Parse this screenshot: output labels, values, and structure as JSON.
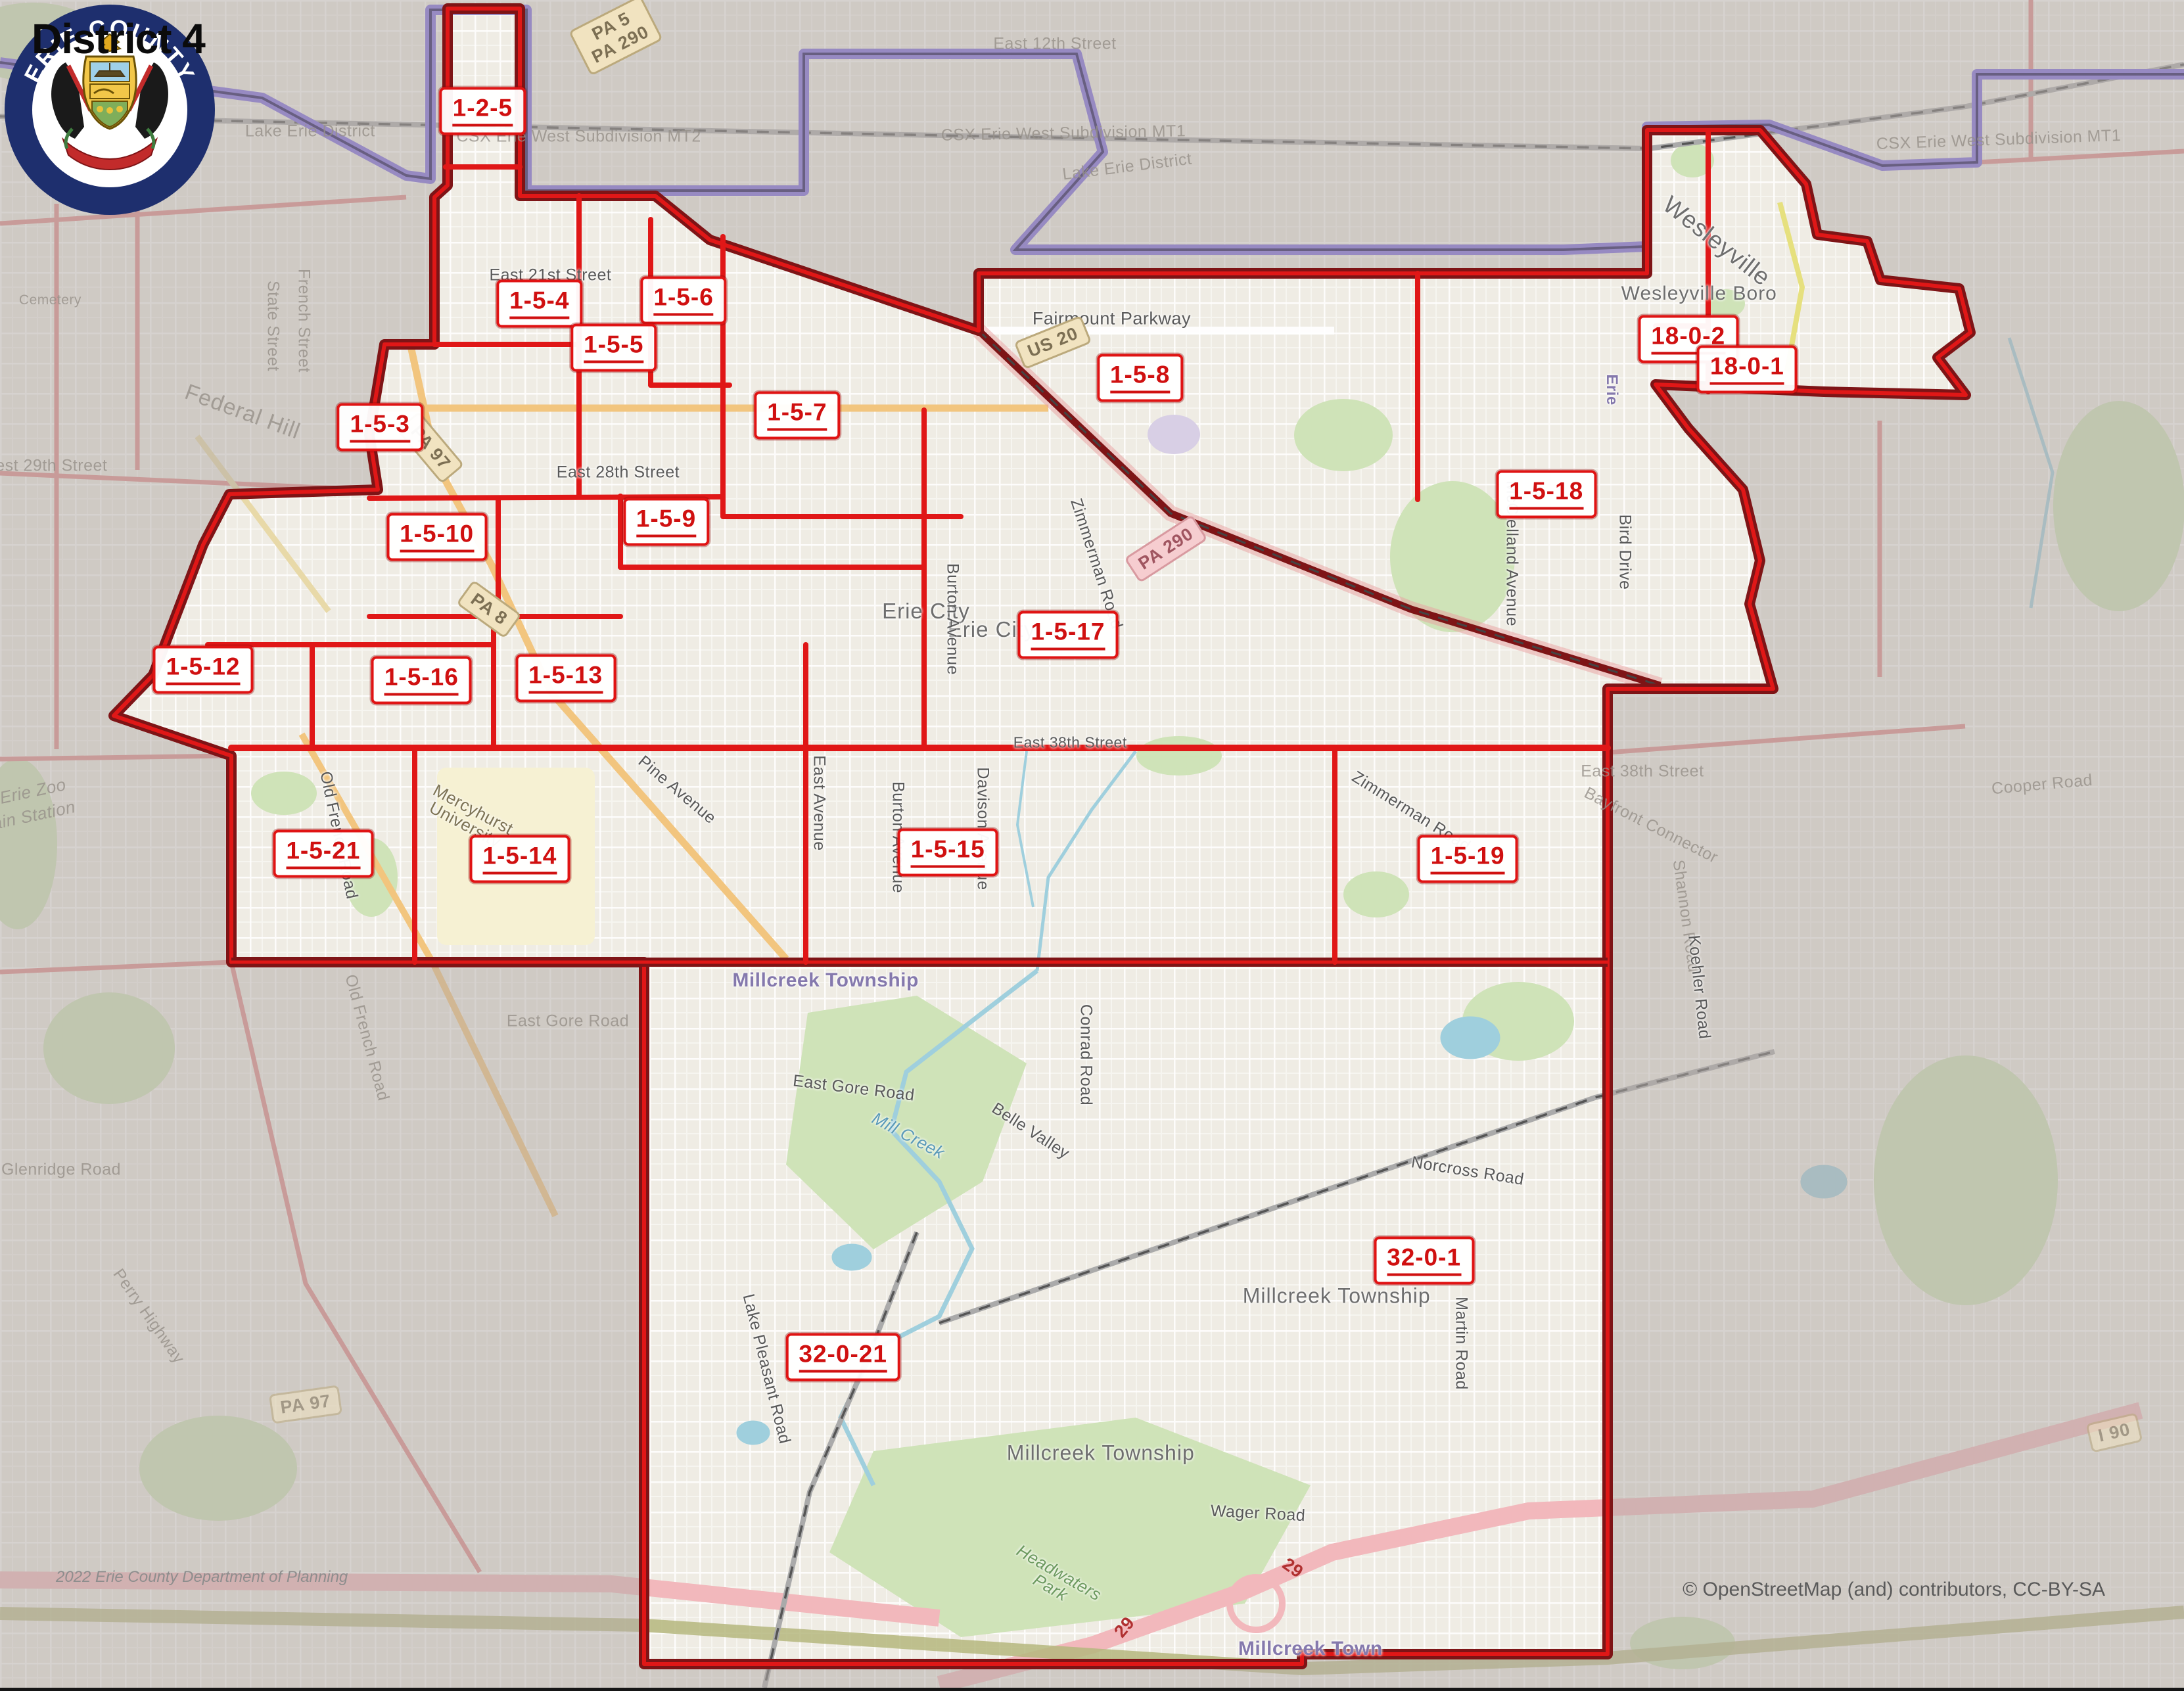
{
  "title": "District 4",
  "attribution": "© OpenStreetMap (and) contributors, CC-BY-SA",
  "credit": "2022 Erie County Department of Planning",
  "seal": {
    "top": "ERIE COUNTY",
    "bottom": "PENNSYLVANIA"
  },
  "colors": {
    "precinct_red": "#d01010",
    "boundary_dark": "#7e1416",
    "boundary_bright": "#e01717",
    "city_line_purple": "#978ac2",
    "outside_veil": "#b3aba6"
  },
  "precincts": [
    {
      "label": "1-2-5",
      "x": 22.1,
      "y": 6.6
    },
    {
      "label": "1-5-4",
      "x": 24.7,
      "y": 18.0
    },
    {
      "label": "1-5-6",
      "x": 31.3,
      "y": 17.8
    },
    {
      "label": "1-5-5",
      "x": 28.1,
      "y": 20.6
    },
    {
      "label": "1-5-3",
      "x": 17.4,
      "y": 25.3
    },
    {
      "label": "1-5-7",
      "x": 36.5,
      "y": 24.6
    },
    {
      "label": "1-5-8",
      "x": 52.2,
      "y": 22.4
    },
    {
      "label": "18-0-2",
      "x": 77.3,
      "y": 20.1
    },
    {
      "label": "18-0-1",
      "x": 80.0,
      "y": 21.9
    },
    {
      "label": "1-5-9",
      "x": 30.5,
      "y": 30.9
    },
    {
      "label": "1-5-10",
      "x": 20.0,
      "y": 31.8
    },
    {
      "label": "1-5-18",
      "x": 70.8,
      "y": 29.3
    },
    {
      "label": "1-5-17",
      "x": 48.9,
      "y": 37.6
    },
    {
      "label": "1-5-12",
      "x": 9.3,
      "y": 39.7
    },
    {
      "label": "1-5-16",
      "x": 19.3,
      "y": 40.3
    },
    {
      "label": "1-5-13",
      "x": 25.9,
      "y": 40.2
    },
    {
      "label": "1-5-21",
      "x": 14.8,
      "y": 50.6
    },
    {
      "label": "1-5-14",
      "x": 23.8,
      "y": 50.9
    },
    {
      "label": "1-5-15",
      "x": 43.4,
      "y": 50.5
    },
    {
      "label": "1-5-19",
      "x": 67.2,
      "y": 50.9
    },
    {
      "label": "32-0-1",
      "x": 65.2,
      "y": 74.7
    },
    {
      "label": "32-0-21",
      "x": 38.6,
      "y": 80.4
    }
  ],
  "streets": [
    {
      "t": "East 12th Street",
      "x": 48.3,
      "y": 2.6,
      "c": "road",
      "m": 1
    },
    {
      "t": "CSX Erie West Subdivision MT1",
      "x": 48.7,
      "y": 7.9,
      "r": -1,
      "c": "road",
      "m": 1
    },
    {
      "t": "Lake Erie District",
      "x": 51.6,
      "y": 9.9,
      "r": -7,
      "c": "road",
      "m": 1
    },
    {
      "t": "Erie",
      "x": 8.7,
      "y": 7.4,
      "c": "water",
      "m": 1
    },
    {
      "t": "Lake Erie District",
      "x": 14.2,
      "y": 7.8,
      "c": "road",
      "m": 1
    },
    {
      "t": "CSX Erie West Subdivision MT2",
      "x": 26.5,
      "y": 8.1,
      "c": "road",
      "m": 1
    },
    {
      "t": "CSX Erie West Subdivision MT1",
      "x": 91.5,
      "y": 8.3,
      "r": -2,
      "c": "road",
      "m": 1
    },
    {
      "t": "East 21st Street",
      "x": 25.2,
      "y": 16.3,
      "c": "road"
    },
    {
      "t": "East 28th Street",
      "x": 28.3,
      "y": 28.0,
      "c": "road"
    },
    {
      "t": "Fairmount Parkway",
      "x": 50.9,
      "y": 18.9,
      "s": 27,
      "c": "road"
    },
    {
      "t": "Wesleyville",
      "x": 78.6,
      "y": 14.3,
      "r": 38,
      "s": 37,
      "c": "place"
    },
    {
      "t": "Wesleyville Boro",
      "x": 77.8,
      "y": 17.4,
      "s": 30,
      "c": "place"
    },
    {
      "t": "Erie City",
      "x": 42.4,
      "y": 36.2,
      "c": "place"
    },
    {
      "t": "Erie City",
      "x": 45.4,
      "y": 37.3,
      "c": "place"
    },
    {
      "t": "Erie",
      "x": 73.8,
      "y": 23.1,
      "r": 90,
      "s": 24,
      "c": "town"
    },
    {
      "t": "Burton Avenue",
      "x": 43.6,
      "y": 36.7,
      "r": 90,
      "c": "road"
    },
    {
      "t": "Burton Avenue",
      "x": 41.1,
      "y": 49.6,
      "r": 90,
      "c": "road"
    },
    {
      "t": "East Avenue",
      "x": 37.5,
      "y": 47.6,
      "r": 90,
      "c": "road"
    },
    {
      "t": "Davison Avenue",
      "x": 45.0,
      "y": 49.1,
      "r": 90,
      "c": "road"
    },
    {
      "t": "Zimmerman Road",
      "x": 50.2,
      "y": 33.4,
      "r": 72,
      "c": "road"
    },
    {
      "t": "Zimmerman Road",
      "x": 64.6,
      "y": 48.1,
      "r": 32,
      "c": "road"
    },
    {
      "t": "McClelland Avenue",
      "x": 69.2,
      "y": 32.8,
      "r": 90,
      "c": "road"
    },
    {
      "t": "Bird Drive",
      "x": 74.4,
      "y": 32.7,
      "r": 90,
      "c": "road"
    },
    {
      "t": "Pine Avenue",
      "x": 31.0,
      "y": 46.8,
      "r": 40,
      "c": "road"
    },
    {
      "t": "Old French Road",
      "x": 15.5,
      "y": 49.5,
      "r": 78,
      "c": "road"
    },
    {
      "t": "Old French Road",
      "x": 16.8,
      "y": 61.5,
      "r": 75,
      "c": "road",
      "m": 1
    },
    {
      "t": "East 38th Street",
      "x": 49.0,
      "y": 44.0,
      "s": 23,
      "c": "road"
    },
    {
      "t": "East 38th Street",
      "x": 75.2,
      "y": 45.7,
      "c": "road",
      "m": 1
    },
    {
      "t": "Bayfront Connector",
      "x": 75.6,
      "y": 48.9,
      "r": 27,
      "c": "road",
      "m": 1
    },
    {
      "t": "Shannon Road",
      "x": 77.2,
      "y": 54.3,
      "r": 82,
      "c": "road",
      "m": 1
    },
    {
      "t": "Cooper Road",
      "x": 93.5,
      "y": 46.5,
      "r": -5,
      "c": "road",
      "m": 1
    },
    {
      "t": "Koehler Road",
      "x": 77.8,
      "y": 58.5,
      "r": 84,
      "c": "road"
    },
    {
      "t": "Conrad Road",
      "x": 49.7,
      "y": 62.5,
      "r": 90,
      "c": "road"
    },
    {
      "t": "East Gore Road",
      "x": 26.0,
      "y": 60.5,
      "c": "road",
      "m": 1
    },
    {
      "t": "East Gore Road",
      "x": 39.1,
      "y": 64.5,
      "r": 7,
      "c": "road"
    },
    {
      "t": "Mill Creek",
      "x": 41.6,
      "y": 67.3,
      "r": 28,
      "c": "water"
    },
    {
      "t": "Belle Valley",
      "x": 47.2,
      "y": 67.0,
      "r": 33,
      "c": "road"
    },
    {
      "t": "Norcross Road",
      "x": 67.2,
      "y": 69.4,
      "r": 9,
      "c": "road"
    },
    {
      "t": "Martin Road",
      "x": 66.9,
      "y": 79.6,
      "r": 90,
      "c": "road"
    },
    {
      "t": "Wager Road",
      "x": 57.6,
      "y": 89.7,
      "r": 3,
      "c": "road"
    },
    {
      "t": "Lake Pleasant Road",
      "x": 35.1,
      "y": 81.1,
      "r": 76,
      "c": "road"
    },
    {
      "t": "Millcreek Township",
      "x": 37.8,
      "y": 58.1,
      "c": "town"
    },
    {
      "t": "Millcreek Township",
      "x": 61.2,
      "y": 76.8,
      "s": 32,
      "c": "place"
    },
    {
      "t": "Millcreek Township",
      "x": 50.4,
      "y": 86.1,
      "s": 32,
      "c": "place"
    },
    {
      "t": "Millcreek Town",
      "x": 60.0,
      "y": 97.7,
      "c": "town"
    },
    {
      "t": "Mercyhurst University",
      "x": 21.5,
      "y": 48.4,
      "r": 28,
      "c": "inst",
      "w": 1
    },
    {
      "t": "Headwaters Park",
      "x": 48.3,
      "y": 93.6,
      "r": 30,
      "c": "park",
      "w": 1
    },
    {
      "t": "Erie Zoo",
      "x": 1.5,
      "y": 46.9,
      "r": -12,
      "c": "water",
      "m": 1
    },
    {
      "t": "Train Station",
      "x": 1.2,
      "y": 48.4,
      "r": -12,
      "c": "water",
      "m": 1
    },
    {
      "t": "Glenridge Road",
      "x": 2.8,
      "y": 69.3,
      "c": "road",
      "m": 1
    },
    {
      "t": "Perry Highway",
      "x": 6.8,
      "y": 78.0,
      "r": 55,
      "c": "road",
      "m": 1
    },
    {
      "t": "West 29th Street",
      "x": 2.0,
      "y": 27.6,
      "c": "road",
      "m": 1
    },
    {
      "t": "Cemetery",
      "x": 2.3,
      "y": 17.8,
      "s": 21,
      "c": "road",
      "m": 1
    },
    {
      "t": "State Street",
      "x": 12.5,
      "y": 19.3,
      "r": 90,
      "c": "road",
      "m": 1
    },
    {
      "t": "French Street",
      "x": 13.9,
      "y": 19.0,
      "r": 90,
      "c": "road",
      "m": 1
    },
    {
      "t": "Federal Hill",
      "x": 11.1,
      "y": 24.4,
      "r": 20,
      "s": 34,
      "c": "place",
      "m": 1
    },
    {
      "t": "29",
      "x": 59.2,
      "y": 92.9,
      "r": 35,
      "c": "num29"
    },
    {
      "t": "29",
      "x": 51.5,
      "y": 96.4,
      "r": -50,
      "c": "num29"
    }
  ],
  "shields": [
    {
      "lines": [
        "PA 5",
        "PA 290"
      ],
      "x": 28.2,
      "y": 2.1,
      "r": -27
    },
    {
      "lines": [
        "US 20"
      ],
      "x": 48.2,
      "y": 20.3,
      "r": -22
    },
    {
      "lines": [
        "PA 97"
      ],
      "x": 19.7,
      "y": 26.5,
      "r": 50
    },
    {
      "lines": [
        "PA 8"
      ],
      "x": 22.4,
      "y": 36.1,
      "r": 36
    },
    {
      "lines": [
        "PA 97"
      ],
      "x": 14.0,
      "y": 83.2,
      "r": -8,
      "m": 1
    },
    {
      "lines": [
        "PA 290"
      ],
      "x": 53.4,
      "y": 32.5,
      "r": -33,
      "p": 1
    },
    {
      "lines": [
        "I 90"
      ],
      "x": 96.8,
      "y": 84.9,
      "r": -13,
      "m": 1
    }
  ]
}
